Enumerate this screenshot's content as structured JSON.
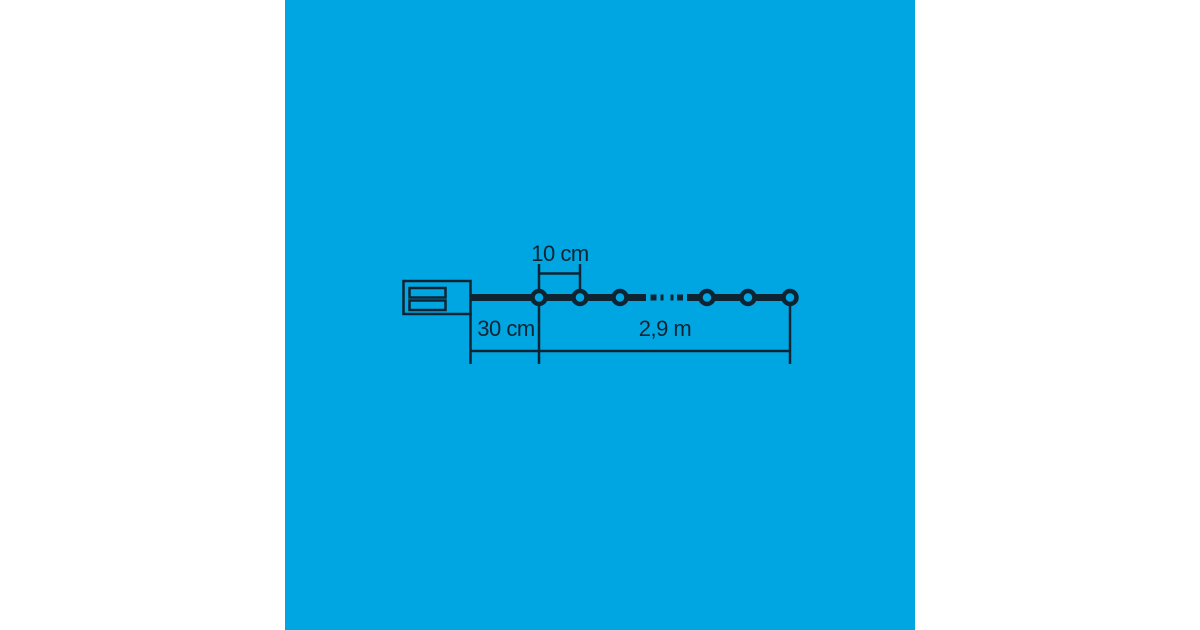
{
  "colors": {
    "canvas_background": "#ffffff",
    "panel_background": "#00a6e2",
    "ink": "#0e2433"
  },
  "diagram": {
    "bulbs_shown": 6,
    "labels": {
      "bulb_spacing": "10 cm",
      "lead_length": "30 cm",
      "chain_length": "2,9 m"
    }
  }
}
